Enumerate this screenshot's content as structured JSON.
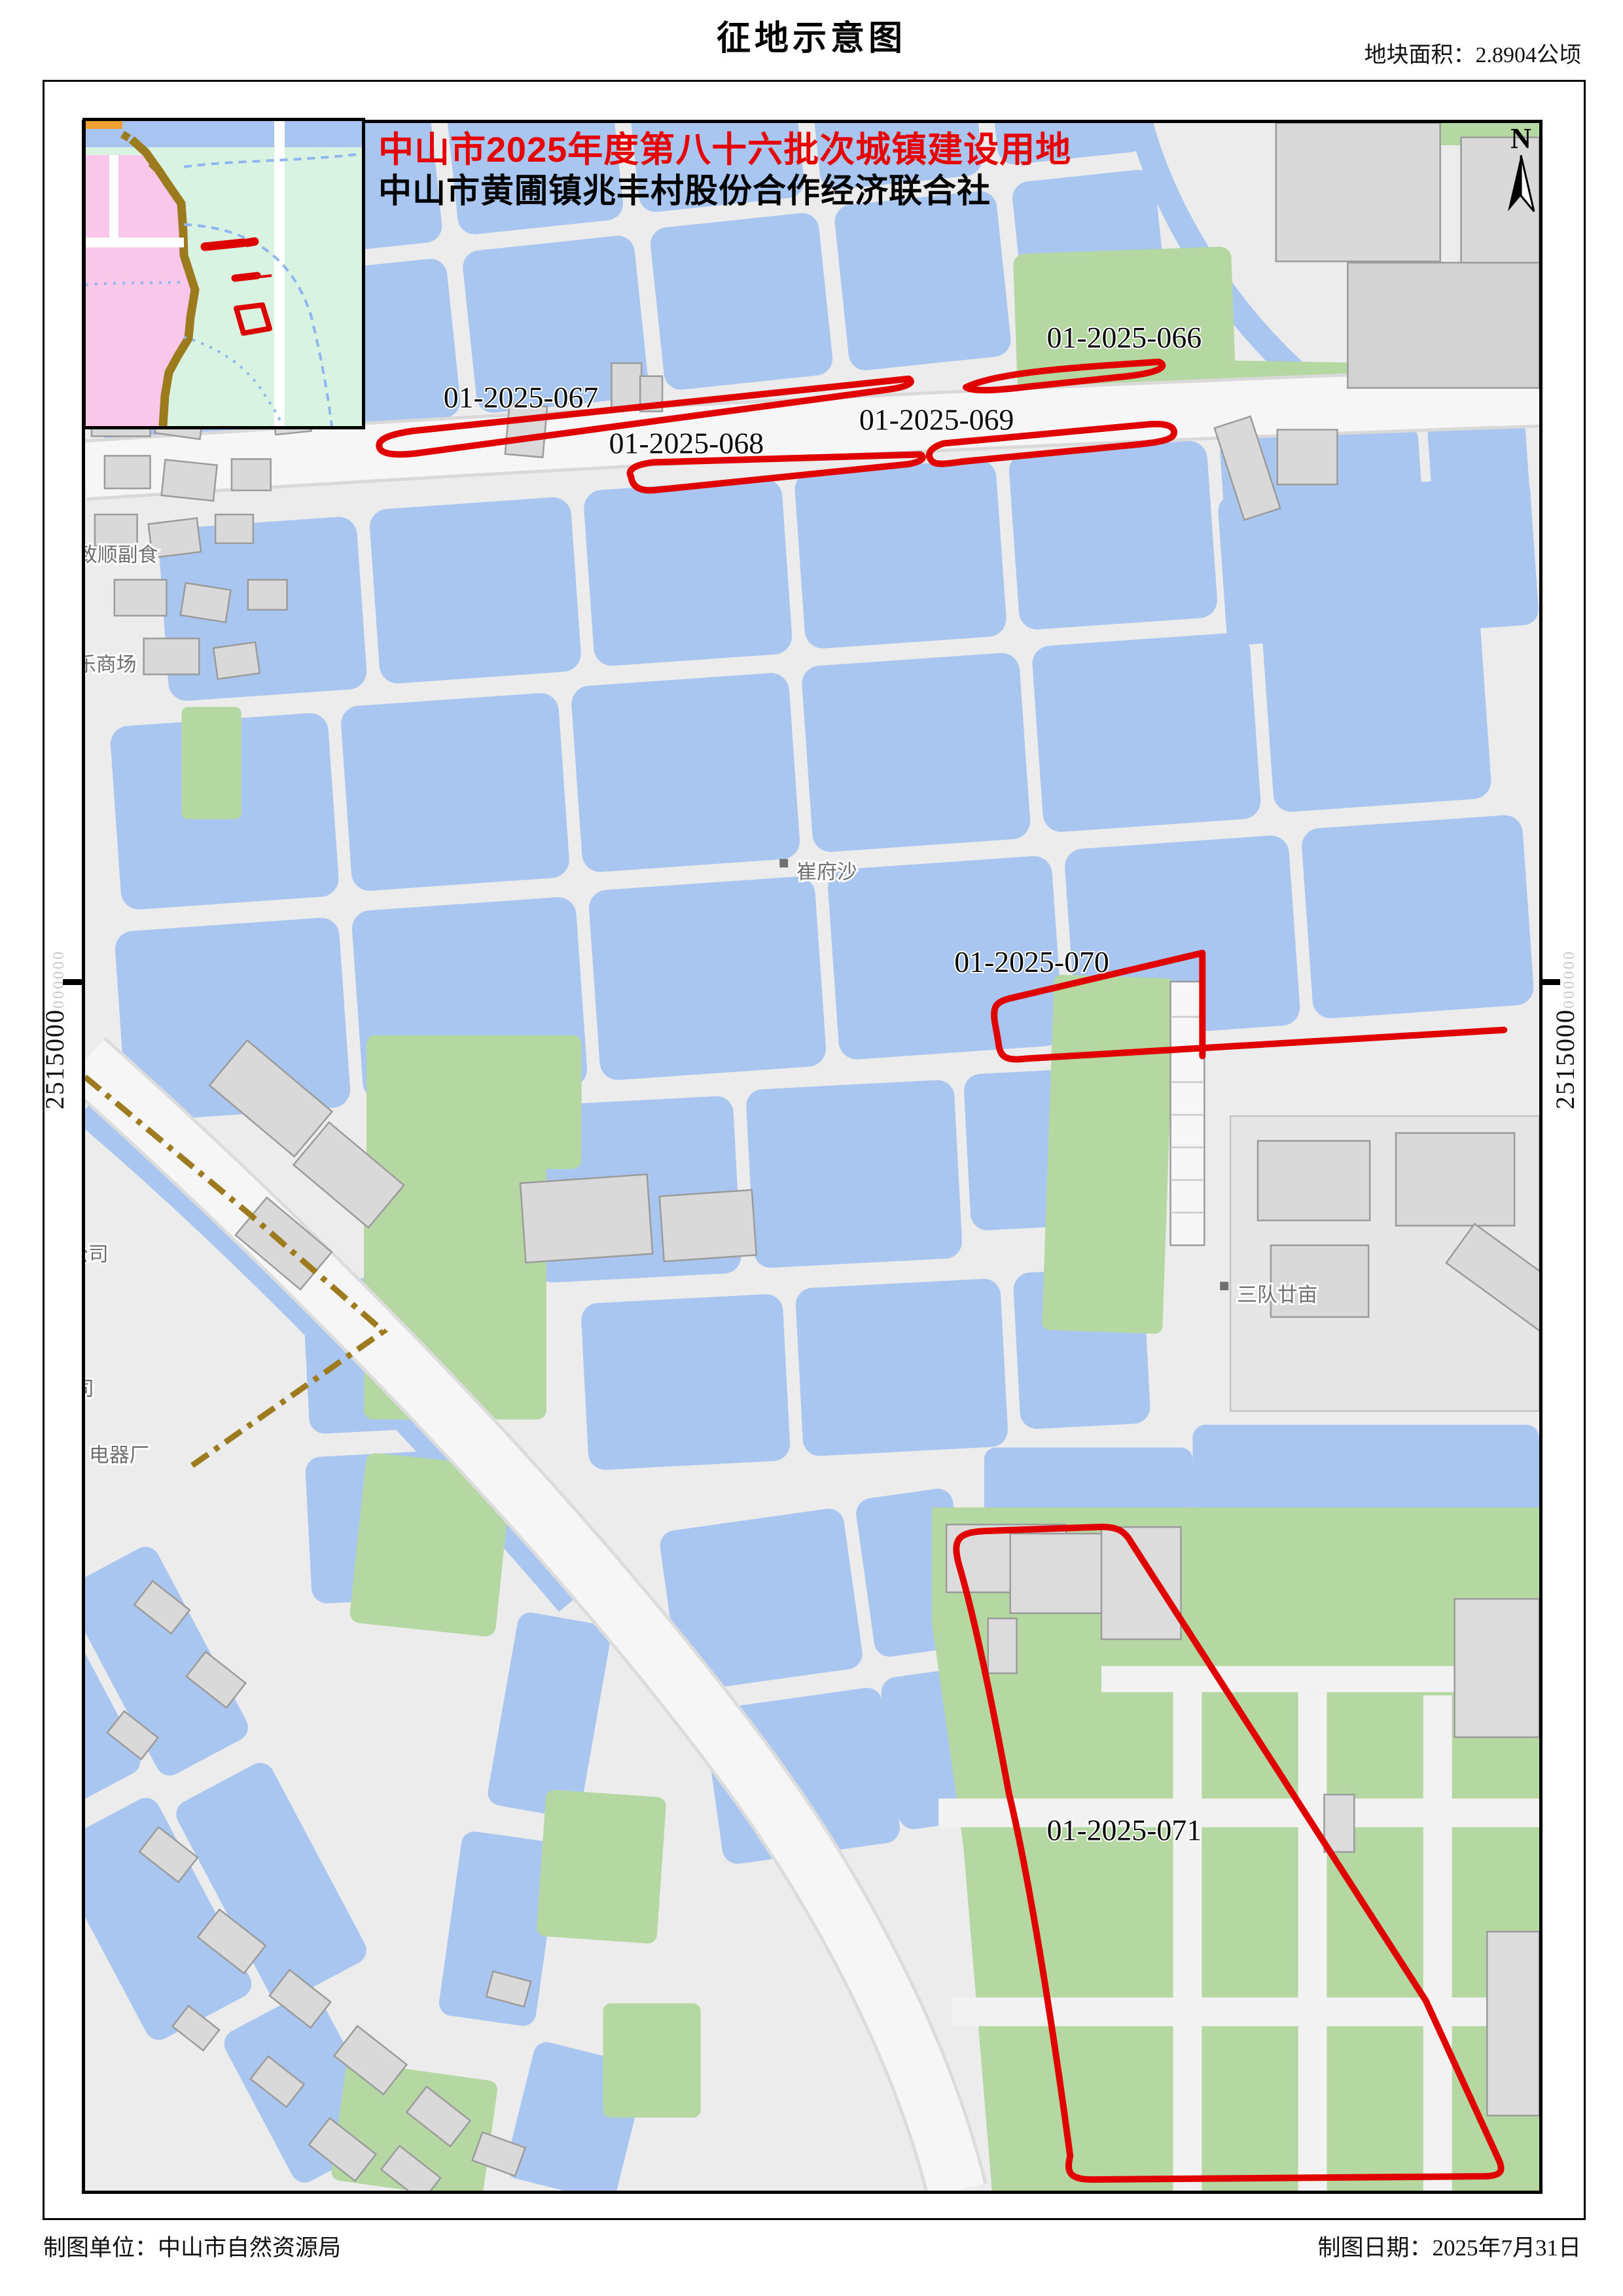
{
  "page": {
    "title": "征地示意图",
    "area_note": "地块面积：2.8904公顷"
  },
  "header": {
    "batch_line": "中山市2025年度第八十六批次城镇建设用地",
    "org_line": "中山市黄圃镇兆丰村股份合作经济联合社"
  },
  "parcel_labels": {
    "p066": "01-2025-066",
    "p067": "01-2025-067",
    "p068": "01-2025-068",
    "p069": "01-2025-069",
    "p070": "01-2025-070",
    "p071": "01-2025-071"
  },
  "coordinates": {
    "left_main": "2515000",
    "left_minor": "000000",
    "right_main": "2515000",
    "right_minor": "000000"
  },
  "compass_label": "N",
  "place_labels": {
    "cuifusha": "崔府沙",
    "sanduiershi": "三队廿亩",
    "zhishun": "致顺副食",
    "shangchang": "乐商场",
    "gongsi_a": "公司",
    "gongsi_b": "公司",
    "dianqichang": "电器厂"
  },
  "footer": {
    "maker": "制图单位：中山市自然资源局",
    "date": "制图日期：2025年7月31日"
  },
  "colors": {
    "water": "#a9c6f0",
    "green": "#b5d8a2",
    "parcel_red": "#e00000",
    "header_red": "#e60000",
    "building": "#d9d9d9",
    "road": "#f6f6f6",
    "land": "#ececec",
    "inset_green": "#d9f3e3",
    "inset_pink": "#f8c7e9",
    "inset_brown": "#9c7a1e"
  }
}
